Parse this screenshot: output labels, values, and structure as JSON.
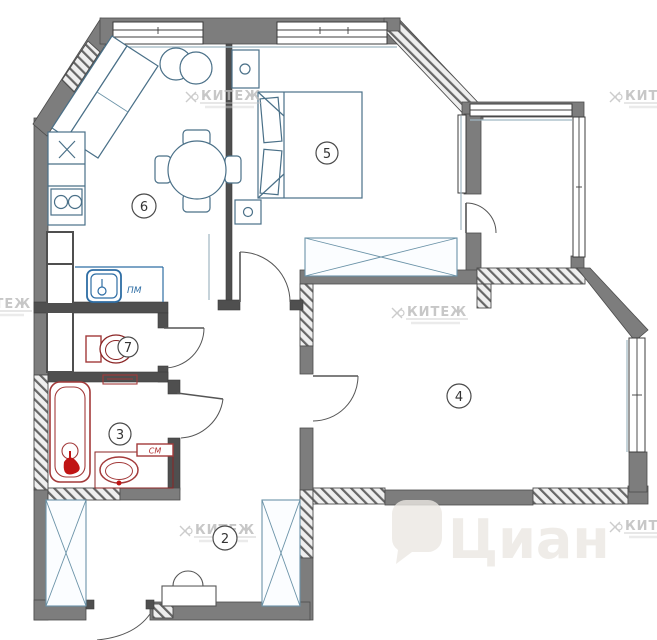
{
  "room_numbers": {
    "hall": "2",
    "bathroom": "3",
    "living_room": "4",
    "bedroom": "5",
    "kitchen": "6",
    "toilet": "7"
  },
  "labels": {
    "dishwasher": "ПМ",
    "washing_machine": "СМ"
  },
  "watermarks": {
    "agency": "КИТЕЖ",
    "portal": "Циан"
  },
  "colors": {
    "wall_gray": "#7d7d7d",
    "wall_dark": "#4f4f4f",
    "furniture_blue": "#4a7088",
    "plumbing_red": "#a33a3a",
    "faucet_red": "#c01414",
    "sink_blue": "#2e6da4",
    "sill_blue": "#9fb6c2",
    "watermark_gray": "#b9b9b9",
    "portal_watermark": "#ebe8e3"
  }
}
